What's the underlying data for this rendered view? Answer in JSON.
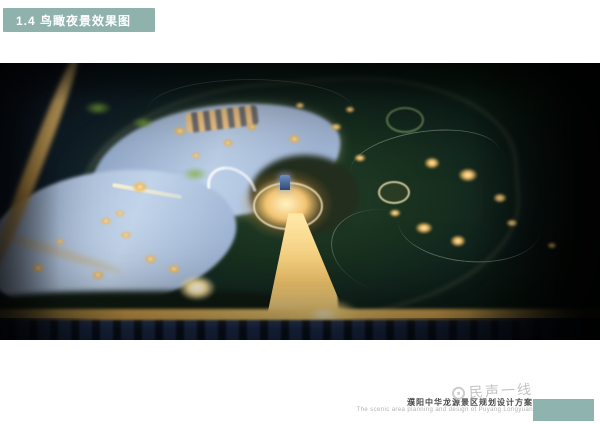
{
  "header": {
    "label": "1.4 鸟瞰夜景效果图",
    "bar_color": "#8fb2ad"
  },
  "figure": {
    "name": "bird-eye-night-view-rendering",
    "colors": {
      "lake": "#bdd0e8",
      "glow": "#ffd87a",
      "park": "#18301e",
      "dark": "#0b1a14"
    }
  },
  "footer": {
    "watermark": "民声一线",
    "title_cn": "濮阳中华龙源景区规划设计方案",
    "title_en": "The scenic area planning and design of Puyang Longyuan",
    "accent_color": "#8fb4af"
  }
}
